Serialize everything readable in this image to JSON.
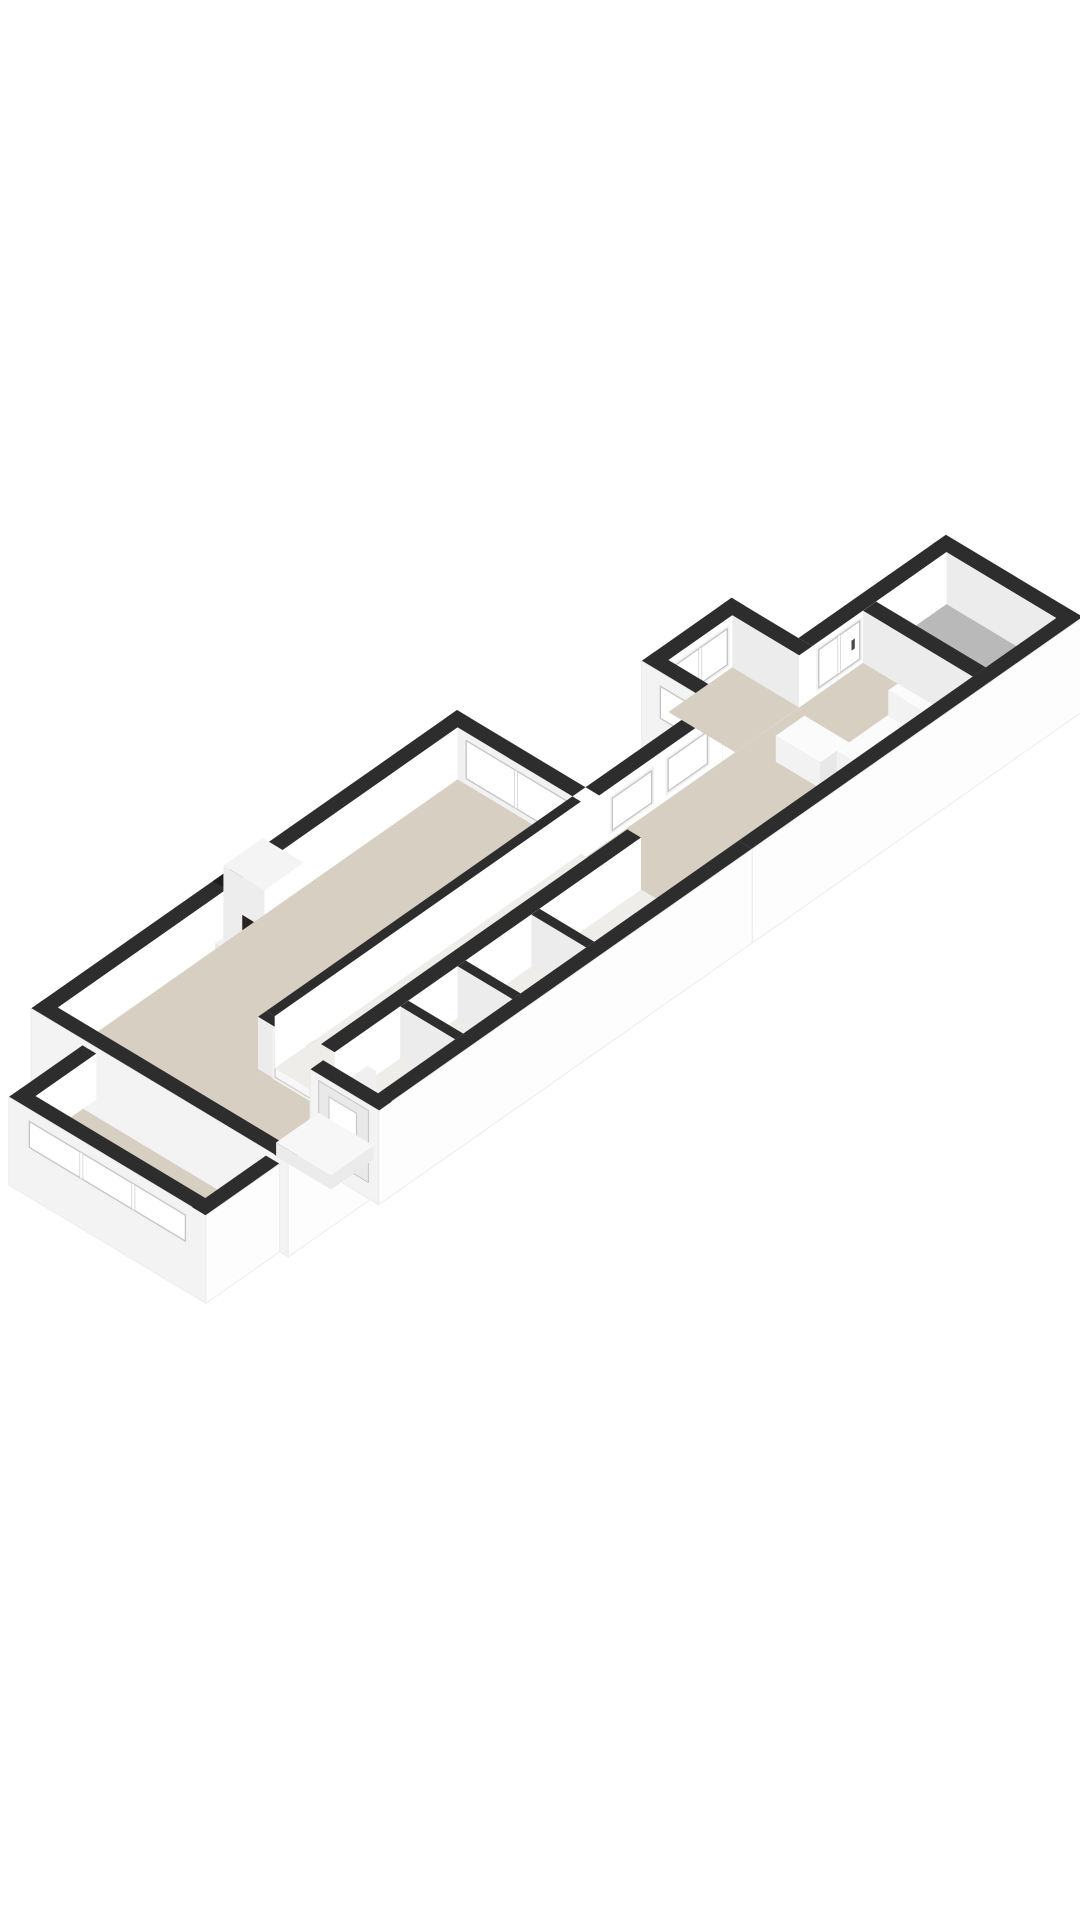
{
  "meta": {
    "description": "3D isometric floor plan of a long apartment with living room, fireplace, hallway, kitchen and balcony room"
  },
  "rooms": [
    {
      "name": "living-room",
      "floor": "beige"
    },
    {
      "name": "bay-window",
      "floor": "beige"
    },
    {
      "name": "hallway",
      "floor": "light"
    },
    {
      "name": "entrance",
      "floor": "light"
    },
    {
      "name": "toilet",
      "floor": "light"
    },
    {
      "name": "storage",
      "floor": "light"
    },
    {
      "name": "kitchen",
      "floor": "beige"
    },
    {
      "name": "kitchen-annex",
      "floor": "beige"
    },
    {
      "name": "balcony-room",
      "floor": "gray"
    }
  ],
  "colors": {
    "background": "#ffffff",
    "wallTop": "#2d2d2d",
    "flue": "#1e1e1e",
    "faceU": "#ffffff",
    "faceV": "#ececec",
    "faceV2": "#f1f1f1",
    "skirtU": "#fdfdfd",
    "skirtV": "#f3f3f3",
    "beige": "#d7cfc2",
    "hallFloor": "#efedea",
    "gray": "#b9b9b9",
    "glass": "#ffffff",
    "frame": "#c4c4c4",
    "casing": "#f2f2f2",
    "white": "#ffffff",
    "door": "#f7f7f7",
    "doorPane": "#ddd6ca",
    "doorLeaf": "#e9e9e9",
    "counterT": "#fbfbfb",
    "counterU": "#f2f2f2",
    "counterV": "#e8e8e8",
    "platform": "#f3f2ef",
    "platformF": "#e9e8e5",
    "chimTop": "#f4f4f4",
    "chimU": "#ededed",
    "radiator": "#f0f0f0",
    "porchTop": "#f7f7f7",
    "porchFace": "#ebebeb",
    "fireDark": "#17120c",
    "fireGlow": "#ffe9a8",
    "logs": "#2a190a",
    "fire1": "#fff3b0",
    "fire2": "#ffc93c",
    "fire3": "#f08a0c",
    "fire4": "#7a3b06",
    "handle": "#4a4a4a"
  },
  "scene": [
    {
      "t": "top",
      "name": "annex-front-wall-top",
      "r": [
        150,
        72,
        260,
        88
      ]
    },
    {
      "t": "fu",
      "name": "annex-front-wall-face",
      "x1": 150,
      "x2": 260,
      "y": 88,
      "zt": 52,
      "h": 52,
      "f": "faceU"
    },
    {
      "t": "winu",
      "name": "annex-front-window",
      "x1": 172,
      "x2": 238,
      "y": 88,
      "z1": 42,
      "z2": 6,
      "mull": 1
    },
    {
      "t": "top",
      "name": "annex-left-wall-top",
      "r": [
        150,
        72,
        166,
        166
      ]
    },
    {
      "t": "fv",
      "name": "annex-left-wall-face",
      "x": 150,
      "y1": 72,
      "y2": 166,
      "zt": 52,
      "h": 94,
      "f": "skirtV"
    },
    {
      "t": "winv",
      "name": "annex-left-window",
      "x": 150,
      "y1": 94,
      "y2": 148,
      "z1": 38,
      "z2": 6
    },
    {
      "t": "top",
      "name": "annex-right-wall-top",
      "r": [
        244,
        72,
        260,
        166
      ]
    },
    {
      "t": "fv",
      "name": "annex-right-wall-face",
      "x": 244,
      "y1": 88,
      "y2": 166,
      "zt": 52,
      "h": 52,
      "f": "faceV"
    },
    {
      "t": "top",
      "name": "kitchen-north-wall-left-top",
      "r": [
        0,
        150,
        150,
        166
      ]
    },
    {
      "t": "fu",
      "name": "kitchen-north-wall-left-face",
      "x1": 0,
      "x2": 150,
      "y": 166,
      "zt": 52,
      "h": 52,
      "f": "faceU"
    },
    {
      "t": "winu",
      "name": "passage-window-1",
      "x1": 16,
      "x2": 64,
      "y": 166,
      "z1": 40,
      "z2": 8
    },
    {
      "t": "winu",
      "name": "passage-window-2",
      "x1": 84,
      "x2": 132,
      "y": 166,
      "z1": 40,
      "z2": 8
    },
    {
      "t": "top",
      "name": "kitchen-north-wall-right-top",
      "r": [
        260,
        150,
        428,
        166
      ]
    },
    {
      "t": "fu",
      "name": "kitchen-north-wall-right-face",
      "x1": 260,
      "x2": 428,
      "y": 166,
      "zt": 52,
      "h": 52,
      "f": "faceU"
    },
    {
      "t": "winu",
      "name": "kitchen-window-door",
      "x1": 268,
      "x2": 318,
      "y": 166,
      "z1": 44,
      "z2": 6,
      "mull": 1,
      "handle": true
    },
    {
      "t": "top",
      "name": "end-room-right-wall-top",
      "r": [
        424,
        150,
        440,
        310
      ]
    },
    {
      "t": "fv",
      "name": "end-room-right-wall-face",
      "x": 424,
      "y1": 166,
      "y2": 294,
      "zt": 52,
      "h": 52,
      "f": "faceV"
    },
    {
      "t": "floor",
      "name": "kitchen-floor",
      "r": [
        -16,
        166,
        322,
        294
      ],
      "f": "beige"
    },
    {
      "t": "floor",
      "name": "balcony-room-floor",
      "r": [
        338,
        166,
        424,
        294
      ],
      "f": "gray"
    },
    {
      "t": "floor",
      "name": "annex-floor",
      "r": [
        166,
        88,
        244,
        166
      ],
      "f": "beige"
    },
    {
      "t": "box",
      "name": "kitchen-island",
      "r": [
        180,
        200,
        215,
        252
      ],
      "h": 26,
      "c0": "counterT",
      "c1": "counterU",
      "c2": "counterV"
    },
    {
      "t": "box",
      "name": "kitchen-counter",
      "r": [
        200,
        252,
        292,
        294
      ],
      "h": 26,
      "c0": "counterT",
      "c1": "counterU",
      "c2": "counterV"
    },
    {
      "t": "box",
      "name": "kitchen-counter-2",
      "r": [
        286,
        230,
        322,
        294
      ],
      "h": 26,
      "c0": "counterT",
      "c1": "counterU",
      "c2": "counterV"
    },
    {
      "t": "top",
      "name": "end-room-divider-top",
      "r": [
        322,
        166,
        338,
        294
      ]
    },
    {
      "t": "fv",
      "name": "end-room-divider-face",
      "x": 322,
      "y1": 166,
      "y2": 294,
      "zt": 52,
      "h": 52,
      "f": "faceV"
    },
    {
      "t": "top",
      "name": "south-wall-right-top",
      "r": [
        36,
        294,
        440,
        310
      ]
    },
    {
      "t": "fu",
      "name": "south-wall-right-skirt",
      "x1": 36,
      "x2": 440,
      "y": 310,
      "zt": 52,
      "h": 94,
      "f": "skirtU"
    },
    {
      "t": "top",
      "name": "living-north-wall-top",
      "r": [
        -520,
        0,
        0,
        16
      ]
    },
    {
      "t": "top",
      "name": "chimney-flue",
      "r": [
        -298,
        0,
        -256,
        16
      ],
      "f": "flue"
    },
    {
      "t": "fu",
      "name": "living-north-wall-face",
      "x1": -520,
      "x2": 0,
      "y": 16,
      "zt": 52,
      "h": 52,
      "f": "faceU"
    },
    {
      "t": "top",
      "name": "living-east-wall-top",
      "r": [
        -16,
        0,
        0,
        150
      ]
    },
    {
      "t": "fv",
      "name": "living-east-wall-face",
      "x": -16,
      "y1": 16,
      "y2": 150,
      "zt": 52,
      "h": 52,
      "f": "faceV2"
    },
    {
      "t": "winv",
      "name": "living-east-window",
      "x": -16,
      "y1": 26,
      "y2": 142,
      "z1": 44,
      "z2": 6,
      "mull": 1
    },
    {
      "t": "box",
      "name": "fireplace-hearth",
      "r": [
        -312,
        16,
        -242,
        88
      ],
      "h": 6,
      "c0": "platform",
      "c1": "platformF",
      "c2": "platformF"
    },
    {
      "t": "box",
      "name": "fireplace-chimney",
      "r": [
        -302,
        16,
        -254,
        64
      ],
      "h": 78,
      "c0": "chimTop",
      "c1": "chimU",
      "c2": "white"
    },
    {
      "t": "fire",
      "name": "fireplace-fire",
      "front": {
        "x": -302,
        "y": 64,
        "zt": 46,
        "dark": [
          6,
          0,
          34,
          38
        ],
        "flame": [
          23,
          27,
          12.5,
          10
        ],
        "glow": [
          23,
          29,
          6.5,
          5
        ],
        "logs": [
          9,
          33,
          28,
          4.5
        ]
      },
      "side": {
        "x": -302,
        "y": 16,
        "zt": 46,
        "dark": [
          22,
          6,
          22,
          32
        ],
        "flame": [
          33,
          24,
          6,
          5
        ]
      }
    },
    {
      "t": "floor",
      "name": "living-room-floor",
      "poly": [
        [
          -504,
          16
        ],
        [
          -16,
          16
        ],
        [
          -16,
          150
        ],
        [
          -400,
          150
        ],
        [
          -400,
          284
        ],
        [
          -504,
          284
        ]
      ],
      "f": "beige"
    },
    {
      "t": "top",
      "name": "hall-west-wall-top",
      "r": [
        -400,
        150,
        -390,
        294
      ]
    },
    {
      "t": "fv",
      "name": "hall-west-wall-face",
      "x": -400,
      "y1": 150,
      "y2": 294,
      "zt": 52,
      "h": 52,
      "f": "faceV"
    },
    {
      "t": "ddv",
      "name": "french-doors",
      "x": -400,
      "y1": 170,
      "y2": 254,
      "z1": 46,
      "z2": 2
    },
    {
      "t": "top",
      "name": "hall-north-wall-top",
      "r": [
        -390,
        150,
        -16,
        160
      ]
    },
    {
      "t": "fu",
      "name": "hall-north-wall-face",
      "x1": -390,
      "x2": -16,
      "y": 160,
      "zt": 52,
      "h": 52,
      "f": "faceU"
    },
    {
      "t": "floor",
      "name": "hallway-floor",
      "r": [
        -390,
        160,
        -16,
        214
      ],
      "f": "hallFloor"
    },
    {
      "t": "top",
      "name": "hall-south-wall-top",
      "r": [
        -390,
        214,
        -16,
        230
      ]
    },
    {
      "t": "fu",
      "name": "hall-south-wall-face",
      "x1": -390,
      "x2": -16,
      "y": 230,
      "zt": 52,
      "h": 52,
      "f": "faceU"
    },
    {
      "t": "floor",
      "name": "small-rooms-floor",
      "r": [
        -390,
        230,
        -16,
        294
      ],
      "f": "hallFloor"
    },
    {
      "t": "top",
      "name": "divider-1-top",
      "r": [
        -310,
        230,
        -300,
        294
      ]
    },
    {
      "t": "fv",
      "name": "divider-1-face",
      "x": -310,
      "y1": 230,
      "y2": 294,
      "zt": 52,
      "h": 52,
      "f": "faceV"
    },
    {
      "t": "top",
      "name": "divider-2-top",
      "r": [
        -240,
        230,
        -230,
        294
      ]
    },
    {
      "t": "fv",
      "name": "divider-2-face",
      "x": -240,
      "y1": 230,
      "y2": 294,
      "zt": 52,
      "h": 52,
      "f": "faceV"
    },
    {
      "t": "top",
      "name": "divider-3-top",
      "r": [
        -150,
        230,
        -140,
        294
      ]
    },
    {
      "t": "fv",
      "name": "divider-3-face",
      "x": -150,
      "y1": 230,
      "y2": 294,
      "zt": 52,
      "h": 52,
      "f": "faceV"
    },
    {
      "t": "box",
      "name": "radiator",
      "r": [
        -386,
        234,
        -354,
        244
      ],
      "h": 20,
      "c0": "radiator",
      "c1": "counterV",
      "c2": "radiator"
    },
    {
      "t": "top",
      "name": "west-wall-top",
      "r": [
        -520,
        0,
        -504,
        300
      ]
    },
    {
      "t": "fv",
      "name": "west-wall-skirt",
      "x": -520,
      "y1": 0,
      "y2": 300,
      "zt": 52,
      "h": 94,
      "f": "skirtV"
    },
    {
      "t": "top",
      "name": "south-wall-left-top",
      "r": [
        -520,
        284,
        -420,
        300
      ]
    },
    {
      "t": "fu",
      "name": "south-wall-left-skirt",
      "x1": -520,
      "x2": -420,
      "y": 300,
      "zt": 52,
      "h": 94,
      "f": "skirtU"
    },
    {
      "t": "top",
      "name": "bay-north-wall-top",
      "r": [
        -610,
        60,
        -520,
        76
      ],
      "z": 46
    },
    {
      "t": "fu",
      "name": "bay-north-wall-face",
      "x1": -610,
      "x2": -520,
      "y": 76,
      "zt": 46,
      "h": 46,
      "f": "faceU"
    },
    {
      "t": "floor",
      "name": "bay-floor",
      "r": [
        -596,
        76,
        -536,
        274
      ],
      "f": "beige"
    },
    {
      "t": "top",
      "name": "bay-west-wall-top",
      "r": [
        -610,
        60,
        -594,
        290
      ],
      "z": 46
    },
    {
      "t": "fv",
      "name": "bay-west-wall-skirt",
      "x": -610,
      "y1": 60,
      "y2": 290,
      "zt": 46,
      "h": 88,
      "f": "skirtV"
    },
    {
      "t": "winv",
      "name": "bay-window",
      "x": -610,
      "y1": 84,
      "y2": 266,
      "z1": 34,
      "z2": 8,
      "mull": 2
    },
    {
      "t": "top",
      "name": "bay-south-wall-top",
      "r": [
        -610,
        274,
        -520,
        290
      ],
      "z": 46
    },
    {
      "t": "fu",
      "name": "bay-south-wall-skirt",
      "x1": -610,
      "x2": -520,
      "y": 290,
      "zt": 46,
      "h": 88,
      "f": "skirtU"
    },
    {
      "t": "top",
      "name": "entry-south-wall-top",
      "r": [
        -420,
        294,
        36,
        310
      ]
    },
    {
      "t": "fu",
      "name": "entry-south-wall-skirt",
      "x1": -420,
      "x2": 36,
      "y": 310,
      "zt": 52,
      "h": 94,
      "f": "skirtU"
    },
    {
      "t": "top",
      "name": "entry-west-wall-top",
      "r": [
        -420,
        230,
        -404,
        310
      ]
    },
    {
      "t": "fv",
      "name": "entry-west-wall-face",
      "x": -420,
      "y1": 230,
      "y2": 310,
      "zt": 52,
      "h": 94,
      "f": "skirtV"
    },
    {
      "t": "doorv",
      "name": "front-door",
      "x": -420,
      "y1": 240,
      "y2": 298,
      "z1": 46,
      "z2": -26
    },
    {
      "t": "box",
      "name": "porch",
      "r": [
        -472,
        240,
        -420,
        304
      ],
      "h": 14,
      "c0": "porchTop",
      "c1": "porchFace",
      "c2": "porchFace"
    }
  ]
}
